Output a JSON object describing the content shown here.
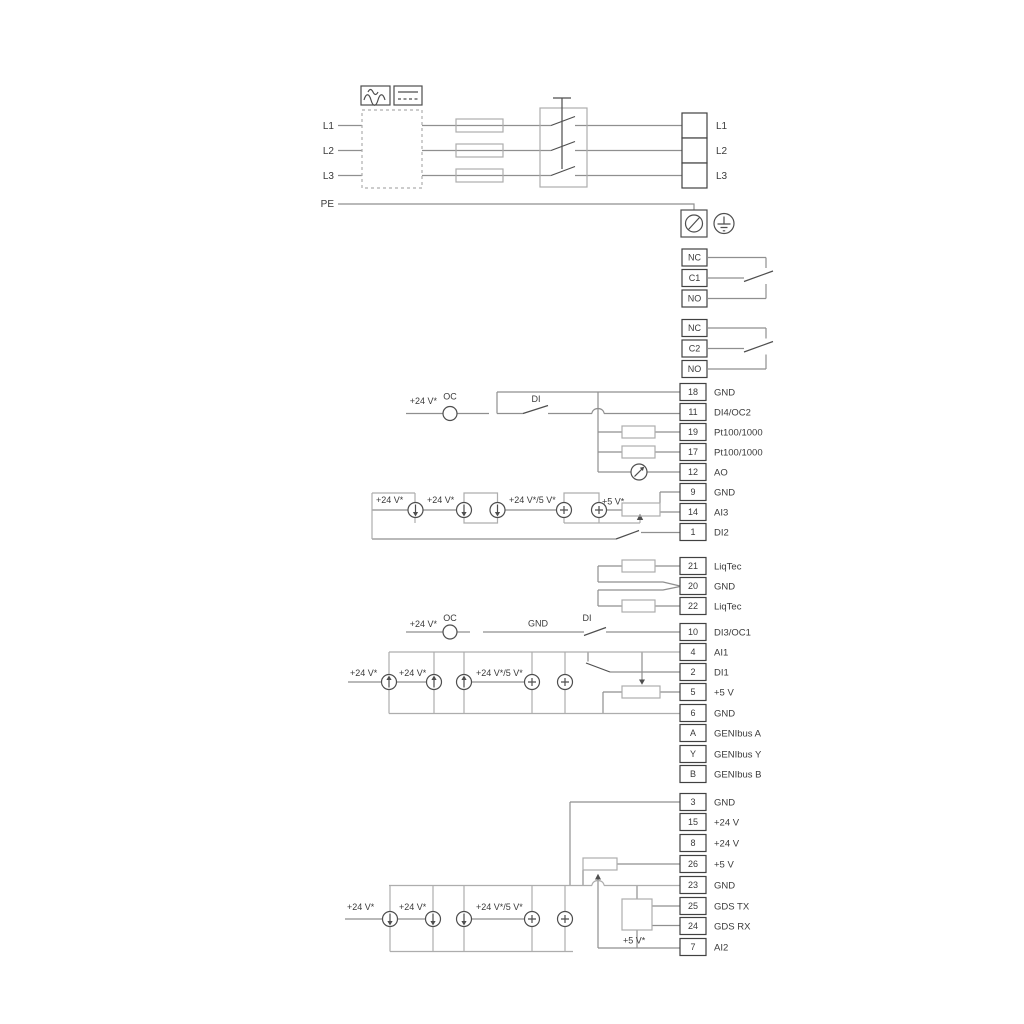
{
  "labels": {
    "l1": "L1",
    "l2": "L2",
    "l3": "L3",
    "pe": "PE",
    "v24": "+24 V*",
    "oc": "OC",
    "di": "DI",
    "gnd": "GND",
    "v24_5": "+24 V*/5 V*",
    "v5": "+5 V*"
  },
  "power_output_terminals": [
    "L1",
    "L2",
    "L3"
  ],
  "relays": [
    {
      "terminals": [
        "NC",
        "C1",
        "NO"
      ]
    },
    {
      "terminals": [
        "NC",
        "C2",
        "NO"
      ]
    }
  ],
  "io_groups": [
    {
      "name": "io-upper",
      "rows": [
        {
          "terminal": "18",
          "label": "GND"
        },
        {
          "terminal": "11",
          "label": "DI4/OC2"
        },
        {
          "terminal": "19",
          "label": "Pt100/1000"
        },
        {
          "terminal": "17",
          "label": "Pt100/1000"
        },
        {
          "terminal": "12",
          "label": "AO"
        },
        {
          "terminal": "9",
          "label": "GND"
        },
        {
          "terminal": "14",
          "label": "AI3"
        },
        {
          "terminal": "1",
          "label": "DI2"
        }
      ]
    },
    {
      "name": "io-liqtec",
      "rows": [
        {
          "terminal": "21",
          "label": "LiqTec"
        },
        {
          "terminal": "20",
          "label": "GND"
        },
        {
          "terminal": "22",
          "label": "LiqTec"
        }
      ]
    },
    {
      "name": "io-middle",
      "rows": [
        {
          "terminal": "10",
          "label": "DI3/OC1"
        },
        {
          "terminal": "4",
          "label": "AI1"
        },
        {
          "terminal": "2",
          "label": "DI1"
        },
        {
          "terminal": "5",
          "label": "+5 V"
        },
        {
          "terminal": "6",
          "label": "GND"
        },
        {
          "terminal": "A",
          "label": "GENIbus A"
        },
        {
          "terminal": "Y",
          "label": "GENIbus Y"
        },
        {
          "terminal": "B",
          "label": "GENIbus B"
        }
      ]
    },
    {
      "name": "io-lower",
      "rows": [
        {
          "terminal": "3",
          "label": "GND"
        },
        {
          "terminal": "15",
          "label": "+24 V"
        },
        {
          "terminal": "8",
          "label": "+24 V"
        },
        {
          "terminal": "26",
          "label": "+5 V"
        },
        {
          "terminal": "23",
          "label": "GND"
        },
        {
          "terminal": "25",
          "label": "GDS TX"
        },
        {
          "terminal": "24",
          "label": "GDS RX"
        },
        {
          "terminal": "7",
          "label": "AI2"
        }
      ]
    }
  ],
  "colors": {
    "wire": "#8f8f8f",
    "rail": "#adadad",
    "symbol": "#4e4e4e",
    "terminal_border": "#414141",
    "text": "#3a3a3a"
  }
}
